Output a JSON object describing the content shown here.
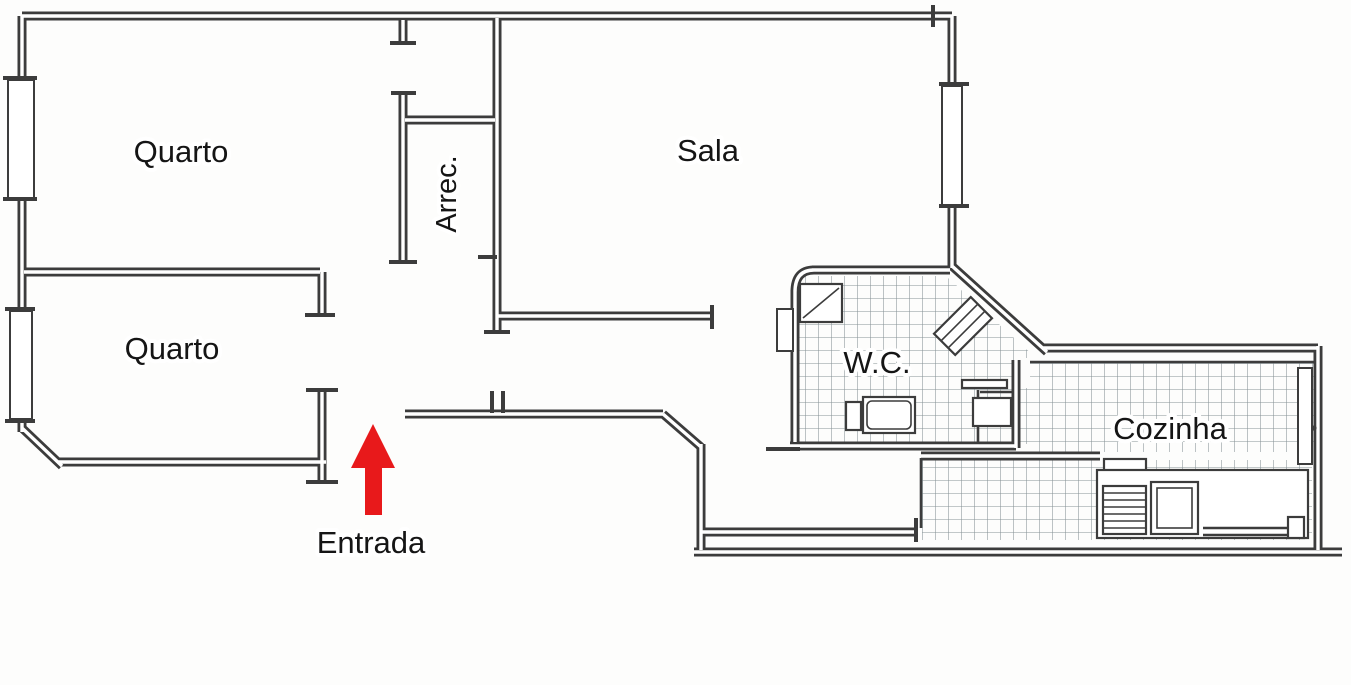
{
  "floor_plan": {
    "background_color": "#fdfdfc",
    "wall_color": "#3c3c3c",
    "tile_line_color": "#5f6e74",
    "text_color": "#151515",
    "rooms": [
      {
        "id": "quarto-1",
        "label": "Quarto"
      },
      {
        "id": "sala",
        "label": "Sala"
      },
      {
        "id": "arrec",
        "label": "Arrec."
      },
      {
        "id": "quarto-2",
        "label": "Quarto"
      },
      {
        "id": "wc",
        "label": "W.C."
      },
      {
        "id": "cozinha",
        "label": "Cozinha"
      }
    ],
    "entrance": {
      "label": "Entrada",
      "arrow_color": "#e8191b",
      "arrow_direction": "up"
    },
    "fixtures": [
      "shower-tray",
      "corner-sink",
      "bathtub",
      "washing-machine",
      "wc-shelf",
      "kitchen-counter",
      "stove",
      "kitchen-sink",
      "radiator",
      "kitchen-door"
    ],
    "features": [
      "exterior-windows",
      "tiled-floor-wc",
      "tiled-floor-kitchen",
      "door-openings"
    ]
  }
}
